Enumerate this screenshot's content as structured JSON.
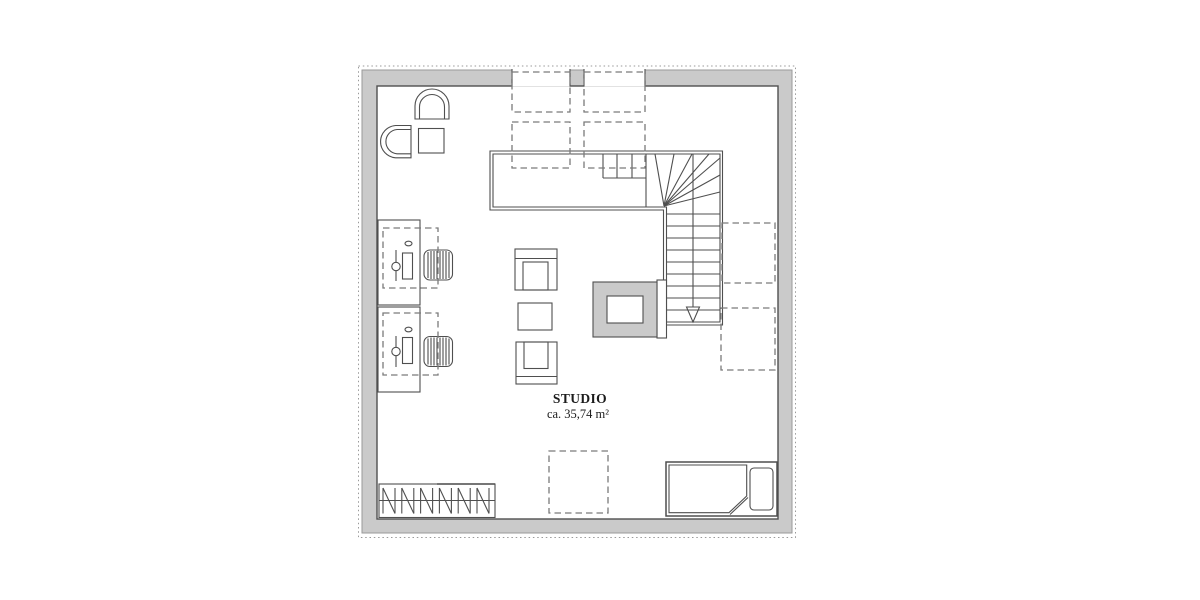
{
  "plan": {
    "room": {
      "name": "STUDIO",
      "area": "ca. 35,74 m²"
    },
    "legend": {
      "fixtures": [
        "toilet",
        "bidet",
        "washbasin"
      ],
      "furniture": [
        "desk-with-lamp",
        "office-chair",
        "armchair",
        "coffee-table",
        "wardrobe-with-hangers",
        "single-bed-with-pillow"
      ],
      "building_elements": [
        "winder-staircase-down",
        "chimney",
        "roof-window-dashed",
        "window-opening",
        "exterior-wall",
        "roof-outline-dotted"
      ]
    },
    "staircase": {
      "direction_arrow": "down"
    }
  },
  "colors": {
    "background": "#ffffff",
    "wall_fill": "#cacaca",
    "wall_edge": "#9a9a9a",
    "line": "#4f4f4f",
    "dashed_line": "#7a7a7a",
    "text": "#1c1c1c"
  }
}
